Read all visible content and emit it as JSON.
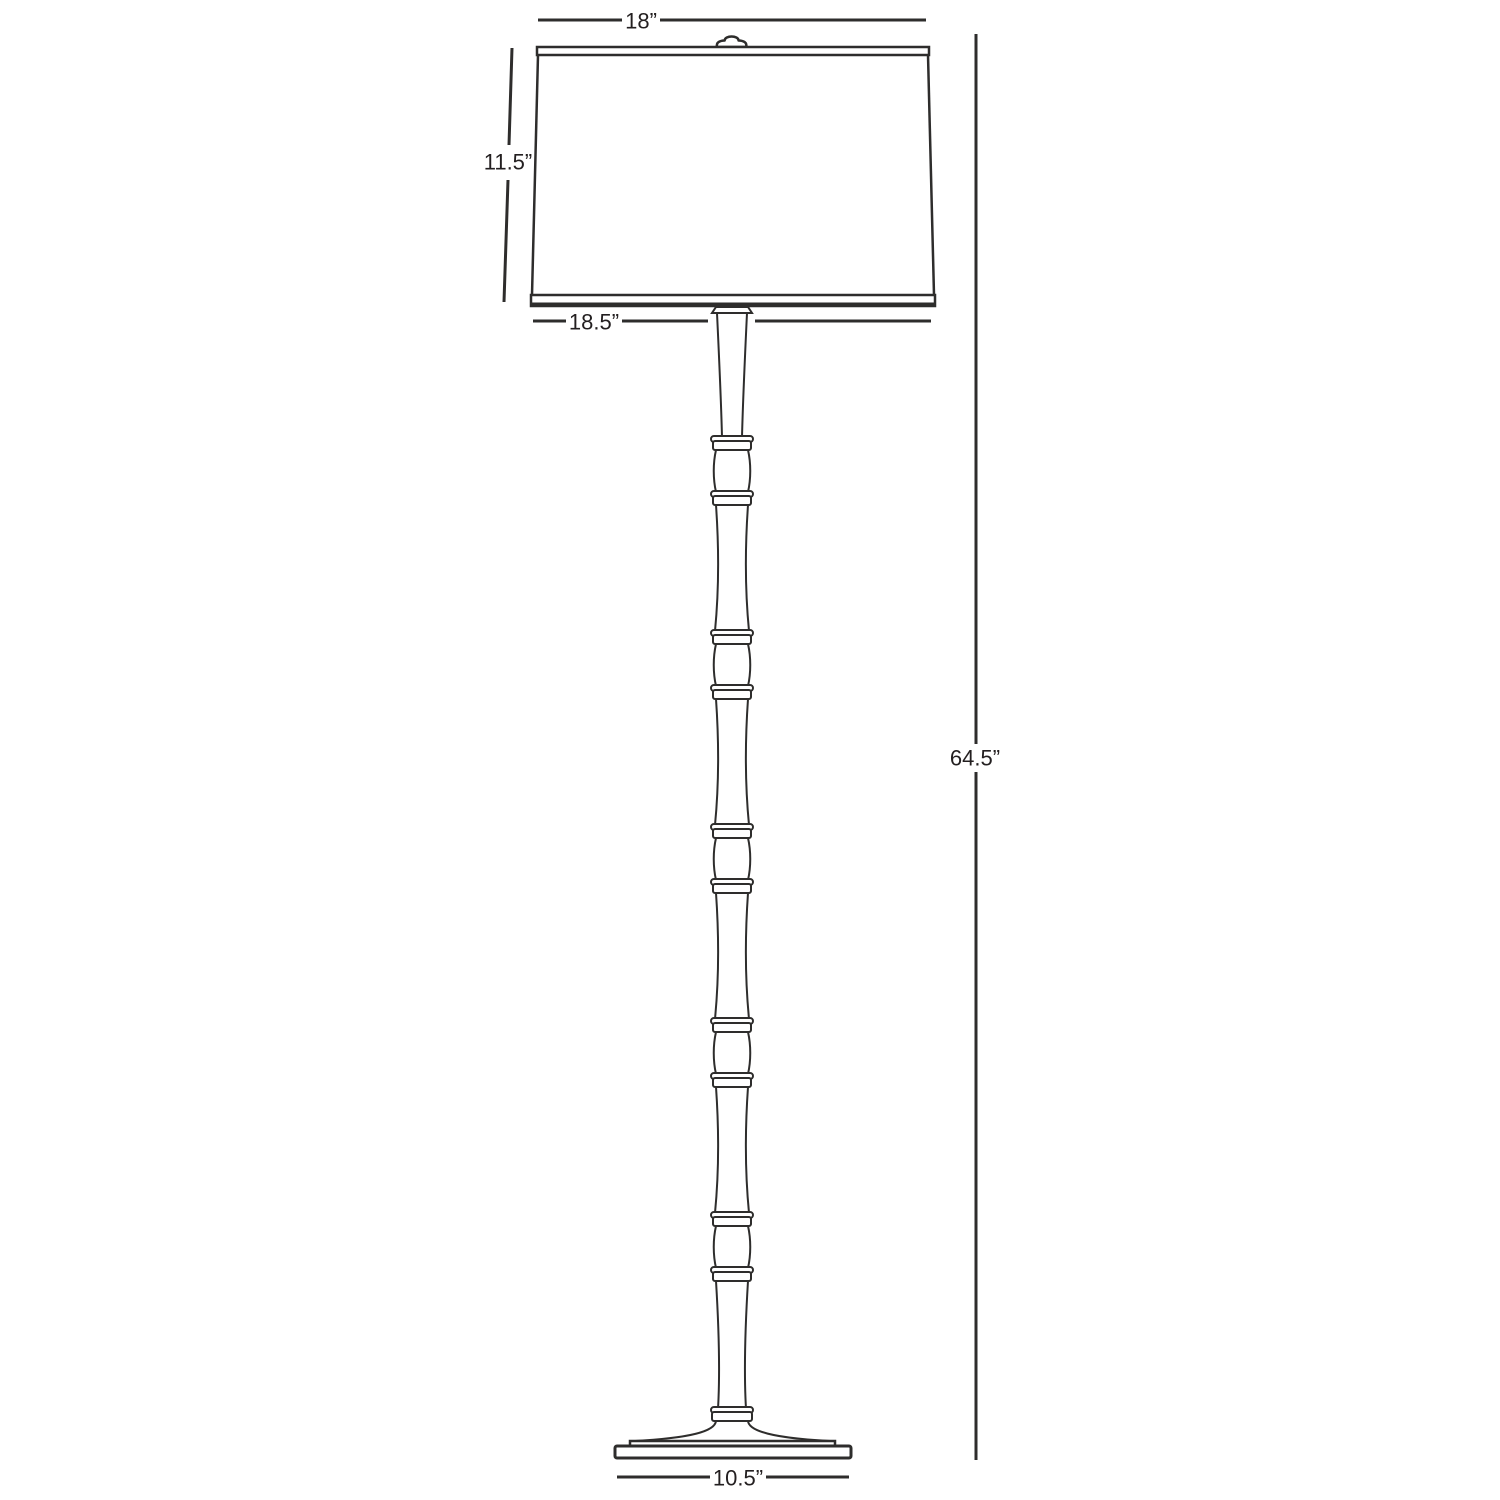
{
  "colors": {
    "line": "#2e2d2c",
    "text": "#231f20",
    "background": "#ffffff"
  },
  "labels": {
    "shade_top_width": "18”",
    "shade_height": "11.5”",
    "shade_bottom_width": "18.5”",
    "overall_height": "64.5”",
    "base_width": "10.5”"
  }
}
